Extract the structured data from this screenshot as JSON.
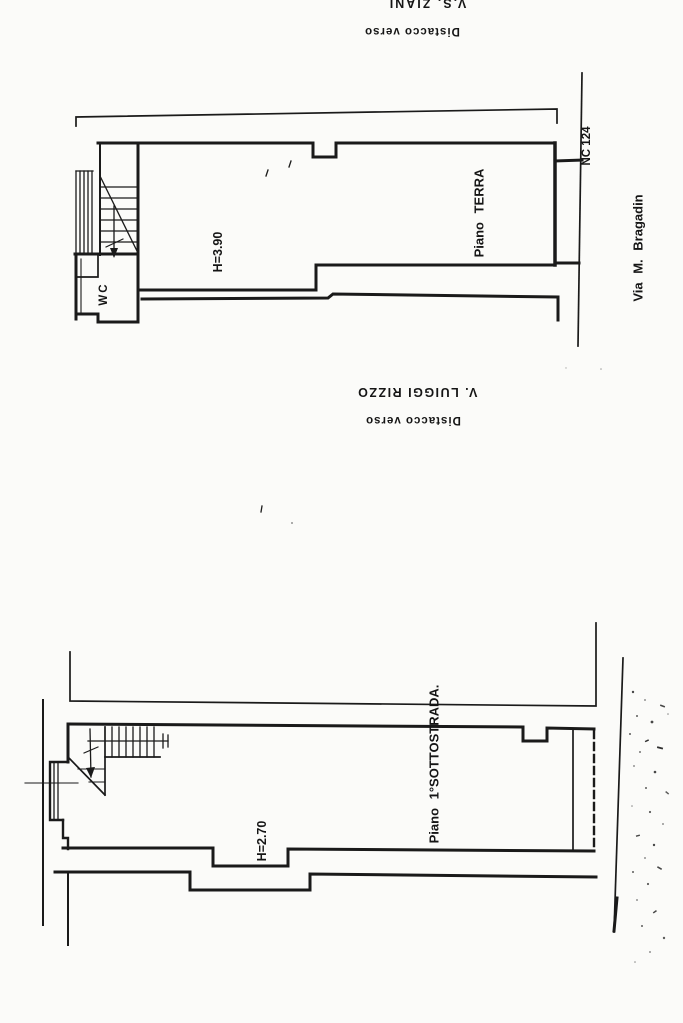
{
  "sheet": {
    "kind": "scanned cadastral floor-plan drawing, rotated 90 degrees",
    "background_color": "#fbfbf9",
    "ink_color": "#1a1a1a"
  },
  "labels": {
    "street_top": "V.S. ZIANI",
    "setback_top": "Distacco verso",
    "setback_mid": "Distacco verso",
    "street_mid": "V. LUIGGI RIZZO",
    "street_right": "Via M. Bragadin",
    "entrance_number": "NC 124",
    "ground_floor_name": "Piano TERRA",
    "ground_floor_height": "H=3.90",
    "wc": "WC",
    "basement_name": "Piano 1°SOTTOSTRADA.",
    "basement_height": "H=2.70"
  }
}
